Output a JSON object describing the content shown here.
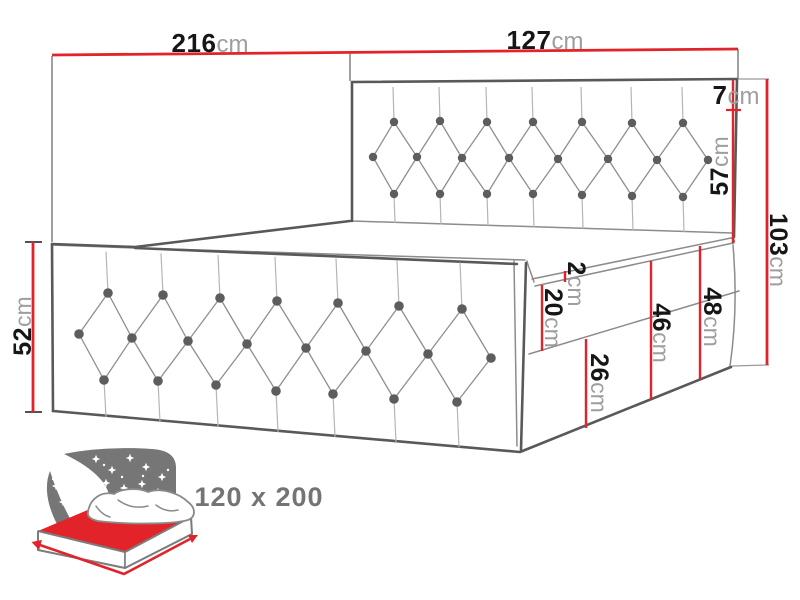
{
  "colors": {
    "dimension_red": "#e2242a",
    "drawing_outline": "#595959",
    "label_number": "#161616",
    "label_unit": "#9e9e9e",
    "icon_gray": "#767676",
    "size_label_gray": "#747474"
  },
  "dims": {
    "bed_length": {
      "num": "216",
      "unit": "cm"
    },
    "headboard_width": {
      "num": "127",
      "unit": "cm"
    },
    "headboard_top_border": {
      "num": "7",
      "unit": "cm"
    },
    "headboard_cushion": {
      "num": "57",
      "unit": "cm"
    },
    "headboard_total": {
      "num": "103",
      "unit": "cm"
    },
    "side_panel_height": {
      "num": "52",
      "unit": "cm"
    },
    "mattress_lip": {
      "num": "2",
      "unit": "cm"
    },
    "mattress_band": {
      "num": "20",
      "unit": "cm"
    },
    "base_box": {
      "num": "26",
      "unit": "cm"
    },
    "band_plus_base": {
      "num": "46",
      "unit": "cm"
    },
    "upholstery_total": {
      "num": "48",
      "unit": "cm"
    }
  },
  "footer": {
    "size_label": "120 x 200"
  }
}
